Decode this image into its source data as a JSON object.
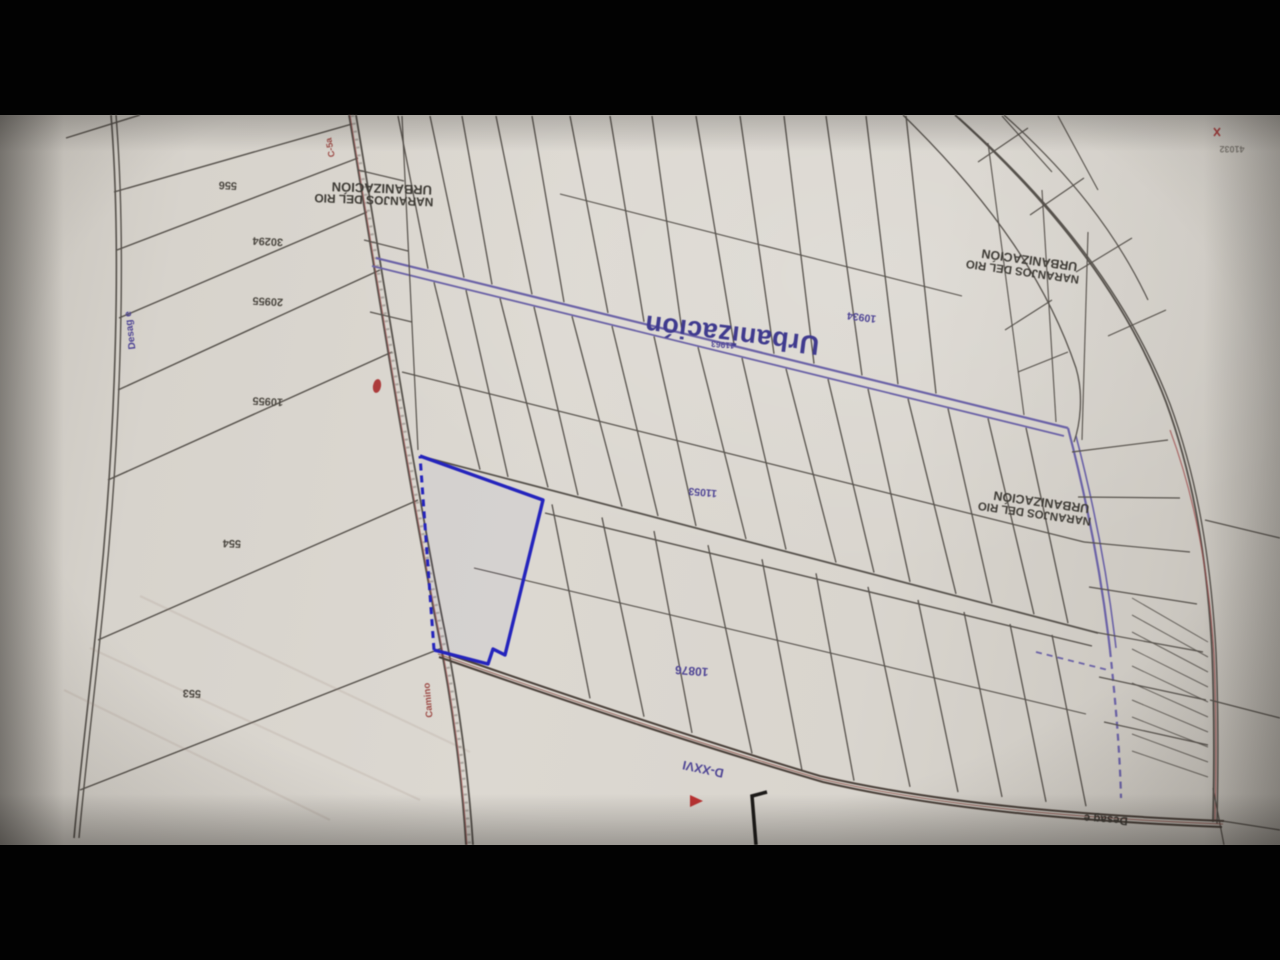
{
  "photo": {
    "paper_color": "#d8d4cc",
    "top_bar_px": 115,
    "bottom_bar_px": 115
  },
  "map": {
    "colors": {
      "ink_line": "#55504a",
      "purple_line": "#6a61aa",
      "highlight_blue": "#2323c4",
      "red_accent": "#a84848",
      "purple_text": "#4d4398",
      "black_text": "#3a3630"
    },
    "labels": {
      "parcel_556": "556",
      "parcel_30294": "30294",
      "parcel_20955": "20955",
      "parcel_10955": "10955",
      "parcel_554": "554",
      "parcel_553": "553",
      "urbanization_big": "Urbanización",
      "urbanization_line1": "URBANIZACIÓN",
      "urbanization_line2": "NARANJOS DEL RIO",
      "num_10934": "10934",
      "num_11963": "11963",
      "num_11053": "11053",
      "num_10876": "10876",
      "num_41032": "41032",
      "drain_code": "D-XXVI",
      "drain_label": "Desag e",
      "camino_label": "Camino",
      "road_code_c5a": "C-5a"
    }
  }
}
